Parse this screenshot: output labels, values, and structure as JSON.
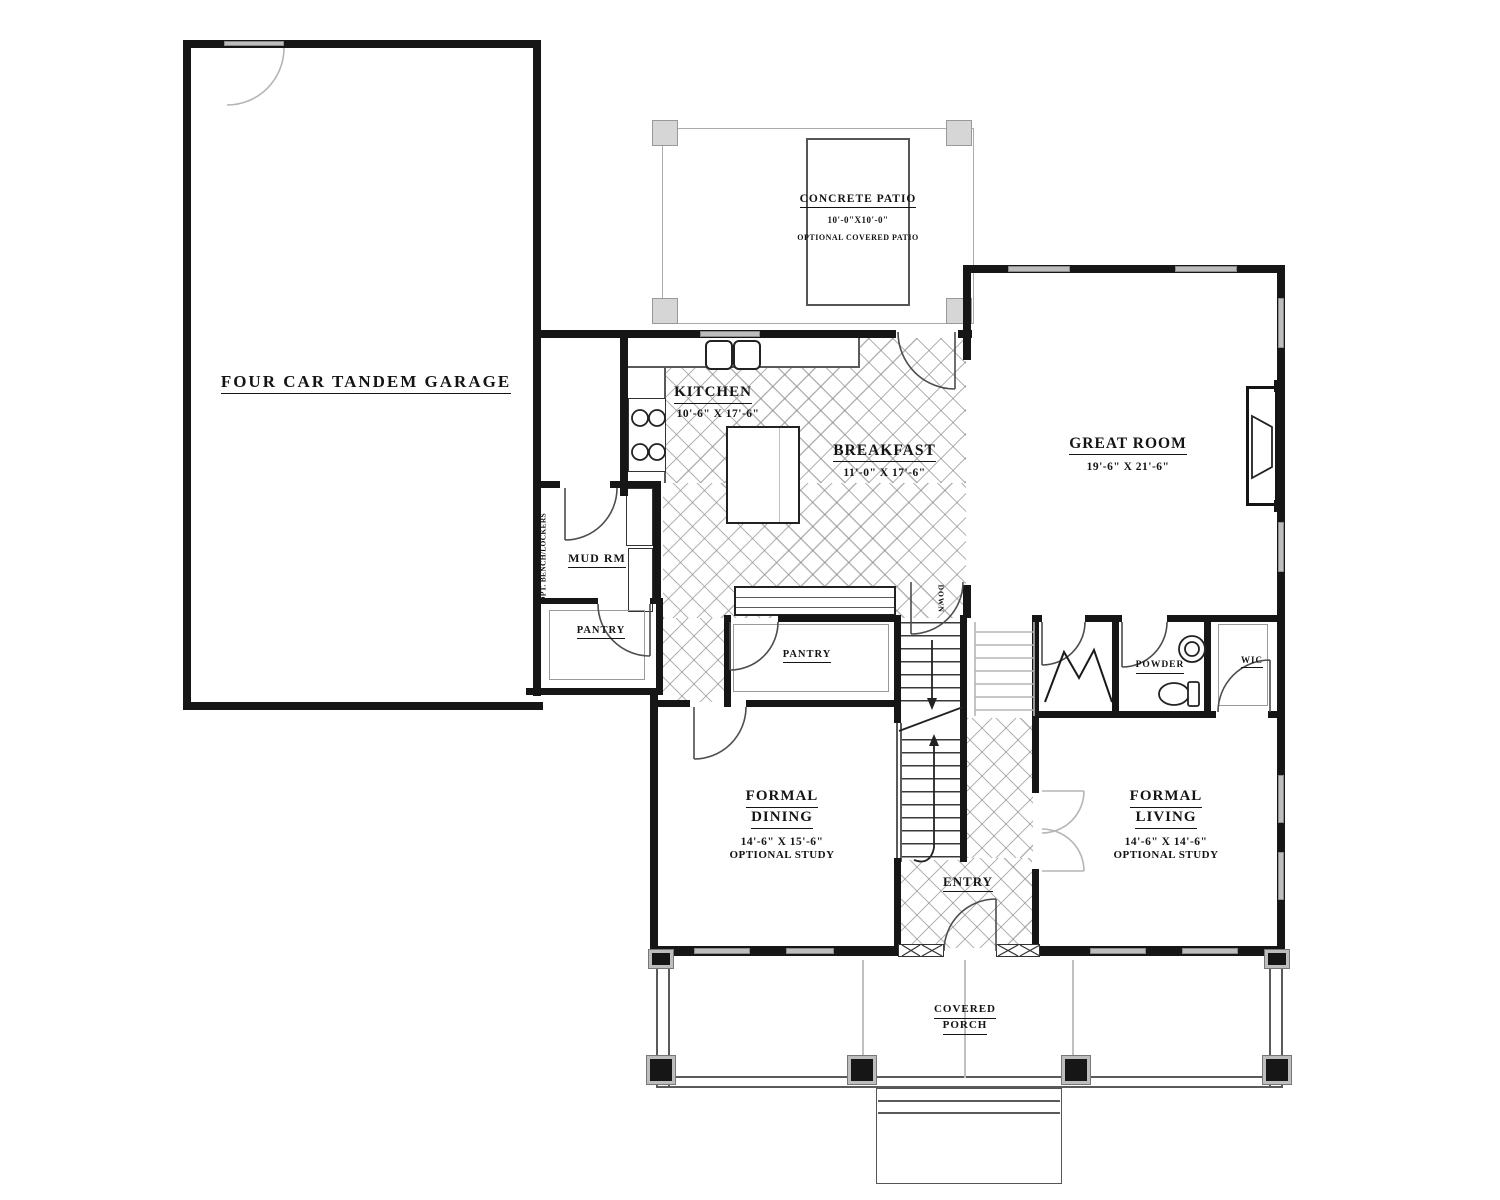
{
  "rooms": {
    "garage": {
      "label": "FOUR CAR TANDEM GARAGE"
    },
    "patio": {
      "label": "CONCRETE PATIO",
      "dims": "10'-0\"X10'-0\"",
      "note": "OPTIONAL COVERED PATIO"
    },
    "kitchen": {
      "label": "KITCHEN",
      "dims": "10'-6\" X 17'-6\""
    },
    "breakfast": {
      "label": "BREAKFAST",
      "dims": "11'-0\" X 17'-6\""
    },
    "great_room": {
      "label": "GREAT ROOM",
      "dims": "19'-6\" X 21'-6\""
    },
    "mud_room": {
      "label": "MUD RM",
      "bench_note": "OPT. BENCH/LOCKERS"
    },
    "pantry_a": {
      "label": "PANTRY"
    },
    "pantry_b": {
      "label": "PANTRY"
    },
    "powder": {
      "label": "POWDER"
    },
    "wic": {
      "label": "WIC"
    },
    "formal_dining": {
      "label_line1": "FORMAL",
      "label_line2": "DINING",
      "dims": "14'-6\" X 15'-6\"",
      "note": "OPTIONAL STUDY"
    },
    "formal_living": {
      "label_line1": "FORMAL",
      "label_line2": "LIVING",
      "dims": "14'-6\" X 14'-6\"",
      "note": "OPTIONAL STUDY"
    },
    "entry": {
      "label": "ENTRY"
    },
    "covered_porch": {
      "label_line1": "COVERED",
      "label_line2": "PORCH"
    },
    "stairs": {
      "direction_label": "DOWN"
    }
  },
  "colors": {
    "wall": "#161616",
    "window_fill": "#bdbdbd",
    "hatch_line": "#8c8c8c",
    "ghost": "#c4c4c4",
    "paper": "#ffffff"
  }
}
